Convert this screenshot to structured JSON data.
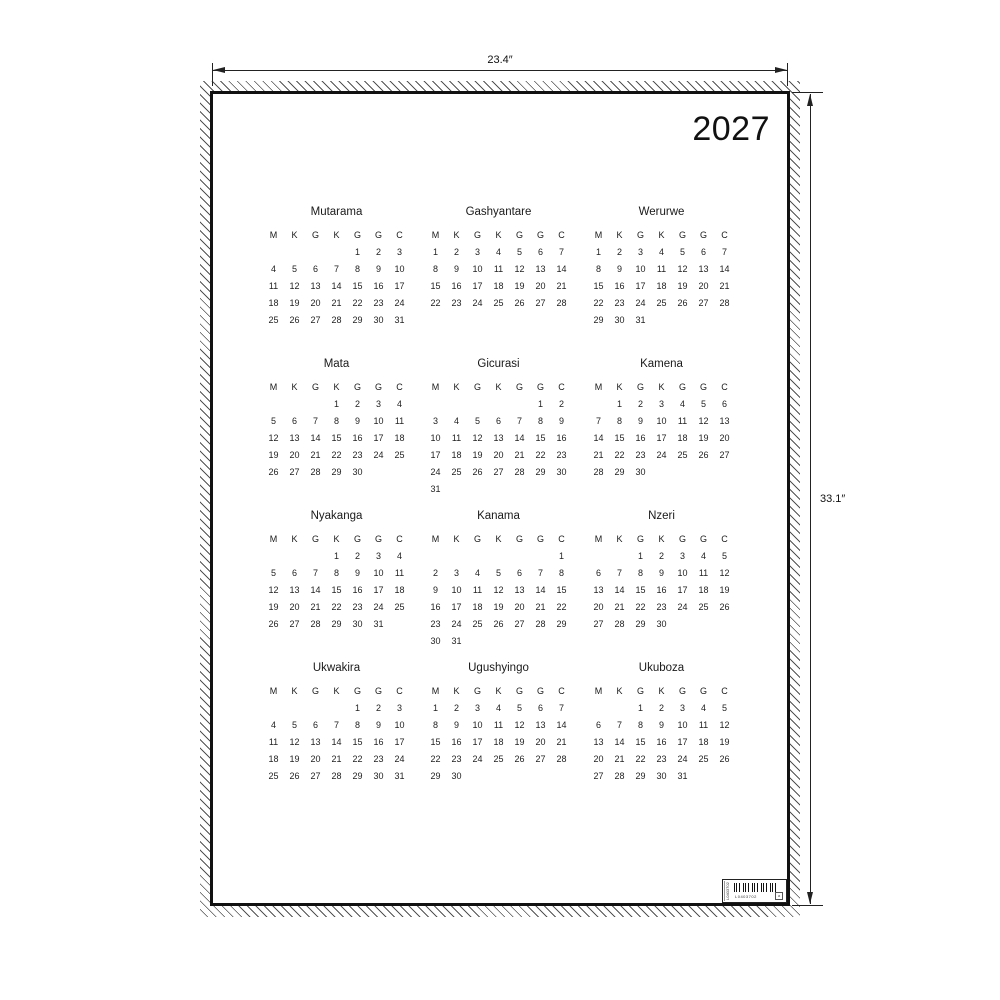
{
  "poster": {
    "year": "2027"
  },
  "dimensions": {
    "width_label": "23.4″",
    "height_label": "33.1″"
  },
  "calendar": {
    "day_headers": [
      "M",
      "K",
      "G",
      "K",
      "G",
      "G",
      "C"
    ],
    "months": [
      {
        "name": "Mutarama",
        "weeks": [
          [
            "",
            "",
            "",
            "",
            "1",
            "2",
            "3"
          ],
          [
            "4",
            "5",
            "6",
            "7",
            "8",
            "9",
            "10"
          ],
          [
            "11",
            "12",
            "13",
            "14",
            "15",
            "16",
            "17"
          ],
          [
            "18",
            "19",
            "20",
            "21",
            "22",
            "23",
            "24"
          ],
          [
            "25",
            "26",
            "27",
            "28",
            "29",
            "30",
            "31"
          ]
        ]
      },
      {
        "name": "Gashyantare",
        "weeks": [
          [
            "1",
            "2",
            "3",
            "4",
            "5",
            "6",
            "7"
          ],
          [
            "8",
            "9",
            "10",
            "11",
            "12",
            "13",
            "14"
          ],
          [
            "15",
            "16",
            "17",
            "18",
            "19",
            "20",
            "21"
          ],
          [
            "22",
            "23",
            "24",
            "25",
            "26",
            "27",
            "28"
          ]
        ]
      },
      {
        "name": "Werurwe",
        "weeks": [
          [
            "1",
            "2",
            "3",
            "4",
            "5",
            "6",
            "7"
          ],
          [
            "8",
            "9",
            "10",
            "11",
            "12",
            "13",
            "14"
          ],
          [
            "15",
            "16",
            "17",
            "18",
            "19",
            "20",
            "21"
          ],
          [
            "22",
            "23",
            "24",
            "25",
            "26",
            "27",
            "28"
          ],
          [
            "29",
            "30",
            "31",
            "",
            "",
            "",
            ""
          ]
        ]
      },
      {
        "name": "Mata",
        "weeks": [
          [
            "",
            "",
            "",
            "1",
            "2",
            "3",
            "4"
          ],
          [
            "5",
            "6",
            "7",
            "8",
            "9",
            "10",
            "11"
          ],
          [
            "12",
            "13",
            "14",
            "15",
            "16",
            "17",
            "18"
          ],
          [
            "19",
            "20",
            "21",
            "22",
            "23",
            "24",
            "25"
          ],
          [
            "26",
            "27",
            "28",
            "29",
            "30",
            "",
            ""
          ]
        ]
      },
      {
        "name": "Gicurasi",
        "weeks": [
          [
            "",
            "",
            "",
            "",
            "",
            "1",
            "2"
          ],
          [
            "3",
            "4",
            "5",
            "6",
            "7",
            "8",
            "9"
          ],
          [
            "10",
            "11",
            "12",
            "13",
            "14",
            "15",
            "16"
          ],
          [
            "17",
            "18",
            "19",
            "20",
            "21",
            "22",
            "23"
          ],
          [
            "24",
            "25",
            "26",
            "27",
            "28",
            "29",
            "30"
          ],
          [
            "31",
            "",
            "",
            "",
            "",
            "",
            ""
          ]
        ]
      },
      {
        "name": "Kamena",
        "weeks": [
          [
            "",
            "1",
            "2",
            "3",
            "4",
            "5",
            "6"
          ],
          [
            "7",
            "8",
            "9",
            "10",
            "11",
            "12",
            "13"
          ],
          [
            "14",
            "15",
            "16",
            "17",
            "18",
            "19",
            "20"
          ],
          [
            "21",
            "22",
            "23",
            "24",
            "25",
            "26",
            "27"
          ],
          [
            "28",
            "29",
            "30",
            "",
            "",
            "",
            ""
          ]
        ]
      },
      {
        "name": "Nyakanga",
        "weeks": [
          [
            "",
            "",
            "",
            "1",
            "2",
            "3",
            "4"
          ],
          [
            "5",
            "6",
            "7",
            "8",
            "9",
            "10",
            "11"
          ],
          [
            "12",
            "13",
            "14",
            "15",
            "16",
            "17",
            "18"
          ],
          [
            "19",
            "20",
            "21",
            "22",
            "23",
            "24",
            "25"
          ],
          [
            "26",
            "27",
            "28",
            "29",
            "30",
            "31",
            ""
          ]
        ]
      },
      {
        "name": "Kanama",
        "weeks": [
          [
            "",
            "",
            "",
            "",
            "",
            "",
            "1"
          ],
          [
            "2",
            "3",
            "4",
            "5",
            "6",
            "7",
            "8"
          ],
          [
            "9",
            "10",
            "11",
            "12",
            "13",
            "14",
            "15"
          ],
          [
            "16",
            "17",
            "18",
            "19",
            "20",
            "21",
            "22"
          ],
          [
            "23",
            "24",
            "25",
            "26",
            "27",
            "28",
            "29"
          ],
          [
            "30",
            "31",
            "",
            "",
            "",
            "",
            ""
          ]
        ]
      },
      {
        "name": "Nzeri",
        "weeks": [
          [
            "",
            "",
            "1",
            "2",
            "3",
            "4",
            "5"
          ],
          [
            "6",
            "7",
            "8",
            "9",
            "10",
            "11",
            "12"
          ],
          [
            "13",
            "14",
            "15",
            "16",
            "17",
            "18",
            "19"
          ],
          [
            "20",
            "21",
            "22",
            "23",
            "24",
            "25",
            "26"
          ],
          [
            "27",
            "28",
            "29",
            "30",
            "",
            "",
            ""
          ]
        ]
      },
      {
        "name": "Ukwakira",
        "weeks": [
          [
            "",
            "",
            "",
            "",
            "1",
            "2",
            "3"
          ],
          [
            "4",
            "5",
            "6",
            "7",
            "8",
            "9",
            "10"
          ],
          [
            "11",
            "12",
            "13",
            "14",
            "15",
            "16",
            "17"
          ],
          [
            "18",
            "19",
            "20",
            "21",
            "22",
            "23",
            "24"
          ],
          [
            "25",
            "26",
            "27",
            "28",
            "29",
            "30",
            "31"
          ]
        ]
      },
      {
        "name": "Ugushyingo",
        "weeks": [
          [
            "1",
            "2",
            "3",
            "4",
            "5",
            "6",
            "7"
          ],
          [
            "8",
            "9",
            "10",
            "11",
            "12",
            "13",
            "14"
          ],
          [
            "15",
            "16",
            "17",
            "18",
            "19",
            "20",
            "21"
          ],
          [
            "22",
            "23",
            "24",
            "25",
            "26",
            "27",
            "28"
          ],
          [
            "29",
            "30",
            "",
            "",
            "",
            "",
            ""
          ]
        ]
      },
      {
        "name": "Ukuboza",
        "weeks": [
          [
            "",
            "",
            "1",
            "2",
            "3",
            "4",
            "5"
          ],
          [
            "6",
            "7",
            "8",
            "9",
            "10",
            "11",
            "12"
          ],
          [
            "13",
            "14",
            "15",
            "16",
            "17",
            "18",
            "19"
          ],
          [
            "20",
            "21",
            "22",
            "23",
            "24",
            "25",
            "26"
          ],
          [
            "27",
            "28",
            "29",
            "30",
            "31",
            "",
            ""
          ]
        ]
      }
    ]
  },
  "barcode": {
    "code": "L0403702",
    "side_text": "L0403702",
    "mark": "a"
  },
  "colors": {
    "ink": "#1f1f1f",
    "border": "#111111",
    "background": "#ffffff"
  }
}
